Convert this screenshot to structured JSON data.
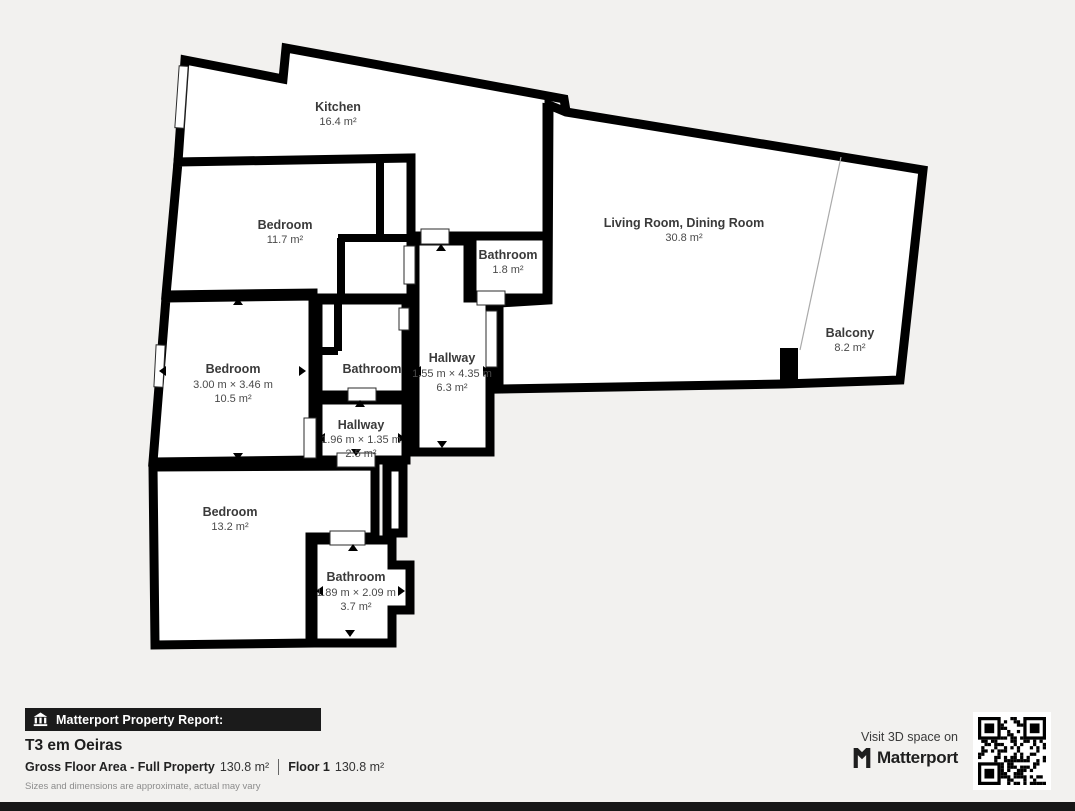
{
  "colors": {
    "background": "#f2f1ef",
    "wall": "#000000",
    "room_fill": "#ffffff",
    "label_text": "#3a3a3a",
    "badge_bg": "#1b1b1b",
    "bottom_bar": "#171717"
  },
  "rooms": {
    "kitchen": {
      "name": "Kitchen",
      "area": "16.4 m²"
    },
    "bedroom1": {
      "name": "Bedroom",
      "area": "11.7 m²"
    },
    "living": {
      "name": "Living Room, Dining Room",
      "area": "30.8 m²"
    },
    "bathroom1": {
      "name": "Bathroom",
      "area": "1.8 m²"
    },
    "bedroom2": {
      "name": "Bedroom",
      "dims": "3.00 m × 3.46 m",
      "area": "10.5 m²"
    },
    "bathroom2": {
      "name": "Bathroom"
    },
    "hallway1": {
      "name": "Hallway",
      "dims": "1.55 m × 4.35 m",
      "area": "6.3 m²"
    },
    "hallway2": {
      "name": "Hallway",
      "dims": "1.96 m × 1.35 m",
      "area": "2.5 m²"
    },
    "balcony": {
      "name": "Balcony",
      "area": "8.2 m²"
    },
    "bedroom3": {
      "name": "Bedroom",
      "area": "13.2 m²"
    },
    "bathroom3": {
      "name": "Bathroom",
      "dims": "1.89 m × 2.09 m",
      "area": "3.7 m²"
    }
  },
  "footer": {
    "report_badge": "Matterport Property Report:",
    "title": "T3 em Oeiras",
    "gfa_label": "Gross Floor Area - Full Property",
    "gfa_value": "130.8 m²",
    "floor_label": "Floor 1",
    "floor_value": "130.8 m²",
    "disclaimer": "Sizes and dimensions are approximate, actual may vary",
    "visit_text": "Visit 3D space on",
    "brand": "Matterport"
  }
}
